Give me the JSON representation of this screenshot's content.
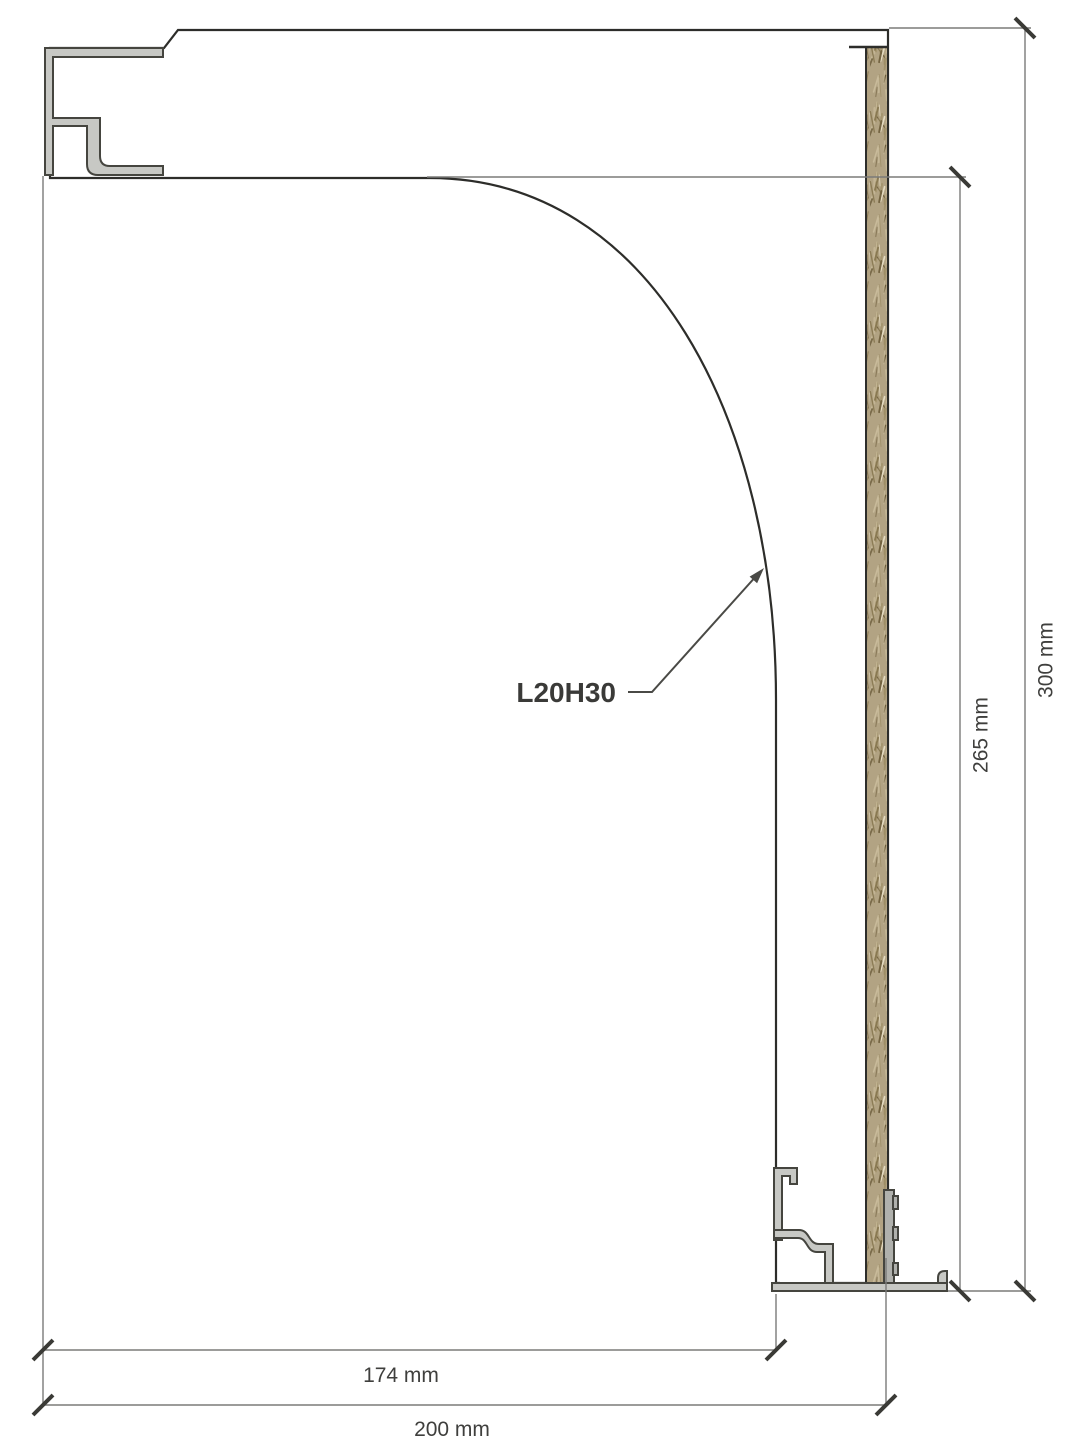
{
  "figure": {
    "type": "technical-cross-section",
    "callout": {
      "label": "L20H30"
    },
    "dimensions": {
      "bottom_inner": "174 mm",
      "bottom_total": "200 mm",
      "right_inner": "265 mm",
      "right_total": "300 mm"
    },
    "colors": {
      "material_base": "#dbe7f3",
      "speckle_palette": [
        "#b7cee4",
        "#96b6d3",
        "#7aa3c6",
        "#648fb4",
        "#cdddec",
        "#f4efe3",
        "#ffffff",
        "#557f9f",
        "#a9c3da"
      ],
      "speckle_dark": "#32322c",
      "woodwool_base": "#b2a383",
      "woodwool_palette": [
        "#86764f",
        "#6d5d3b",
        "#e9dfc6",
        "#57472a",
        "#c9bc9b",
        "#9c8c63"
      ],
      "metal": "#c7c8c4",
      "metal_dark": "#b0b1ad",
      "outline": "#2d2d2a",
      "dimension_line": "#7b7b79",
      "tick": "#3a3a36",
      "label_text": "#3f3f3d"
    }
  }
}
